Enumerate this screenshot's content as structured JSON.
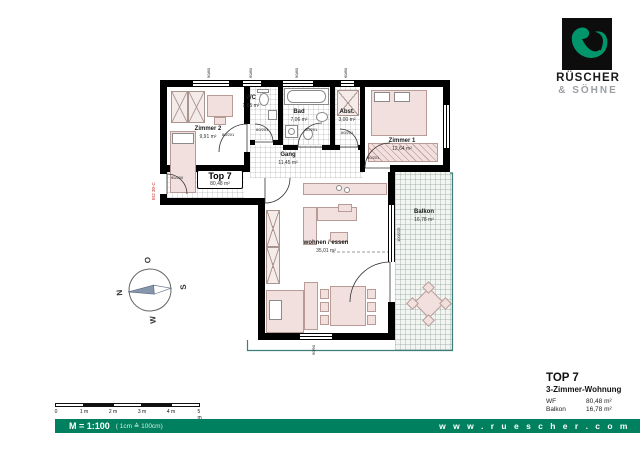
{
  "brand": {
    "name_line1": "RÜSCHER",
    "name_line2": "& SÖHNE",
    "website_spaced": "w w w . r u e s c h e r . c o m"
  },
  "footer": {
    "scale_label": "M = 1:100",
    "scale_note": "( 1cm ≙ 100cm)"
  },
  "scalebar": {
    "tick_labels": [
      "0",
      "1 m",
      "2 m",
      "3 m",
      "4 m",
      "5 m"
    ]
  },
  "info_block": {
    "title": "TOP 7",
    "subtitle": "3-Zimmer-Wohnung",
    "rows": [
      {
        "label": "WF",
        "value": "80,48 m²"
      },
      {
        "label": "Balkon",
        "value": "16,78 m²"
      }
    ]
  },
  "plan": {
    "unit_label": "Top 7",
    "unit_area": "80,48 m²",
    "entrance_fire_rating": "EI2 30-C",
    "rooms": [
      {
        "name": "Zimmer 2",
        "area": "9,91 m²"
      },
      {
        "name": "WC",
        "area": "1,65 m²"
      },
      {
        "name": "Bad",
        "area": "7,06 m²"
      },
      {
        "name": "Abst.",
        "area": "3,00 m²"
      },
      {
        "name": "Zimmer 1",
        "area": "12,64 m²"
      },
      {
        "name": "Gang",
        "area": "11,45 m²"
      },
      {
        "name": "wohnen / essen",
        "area": "35,01 m²"
      },
      {
        "name": "Balkon",
        "area": "16,78 m²"
      }
    ],
    "door_labels": [
      {
        "text": "90/200"
      },
      {
        "text": "80/201"
      },
      {
        "text": "60/201"
      },
      {
        "text": "80/201"
      },
      {
        "text": "60/201"
      },
      {
        "text": "80/201"
      },
      {
        "text": "100/225"
      }
    ],
    "window_marks": [
      {
        "text": "90/80"
      },
      {
        "text": "60/80"
      },
      {
        "text": "90/80"
      },
      {
        "text": "60/80"
      },
      {
        "text": "90/90"
      }
    ]
  },
  "compass": {
    "north": "N",
    "east": "O",
    "south": "S",
    "west": "W"
  },
  "colors": {
    "brand_green": "#00956b",
    "footer_green": "#00805f",
    "wall_black": "#000000",
    "furniture_pink": "#f2e0de",
    "balcony_line": "#3d7f78",
    "fire_red": "#cc2222"
  }
}
